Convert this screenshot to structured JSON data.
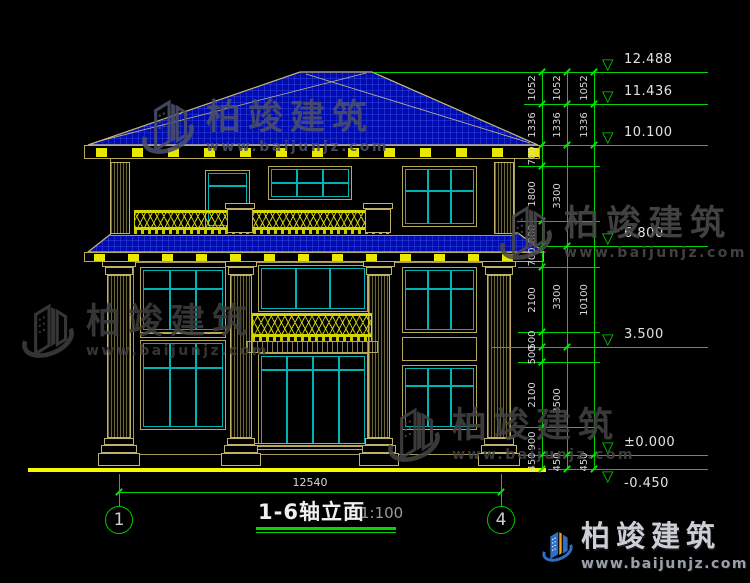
{
  "title": {
    "text": "1-6轴立面",
    "scale": "1:100"
  },
  "axis_bubbles": [
    {
      "label": "1",
      "x": 119
    },
    {
      "label": "4",
      "x": 501
    }
  ],
  "bottom_dimension": {
    "label": "12540",
    "y": 492,
    "x1": 119,
    "x2": 501,
    "text_y": 477
  },
  "elevation_levels": [
    {
      "label": "12.488",
      "y": 72,
      "ext_from": 374
    },
    {
      "label": "11.436",
      "y": 104,
      "ext_from": 524
    },
    {
      "label": "10.100",
      "y": 145,
      "ext_from": 540
    },
    {
      "label": "6.800",
      "y": 246,
      "ext_from": 546
    },
    {
      "label": "3.500",
      "y": 347,
      "ext_from": 492
    },
    {
      "label": "±0.000",
      "y": 455,
      "ext_from": 518
    },
    {
      "label": "-0.450",
      "y": 469,
      "ext_from": 548,
      "below": true
    }
  ],
  "dimension_chains": [
    {
      "x": 542,
      "boundaries": [
        72,
        104,
        145,
        166,
        221,
        246,
        267,
        332,
        347,
        362,
        427,
        455,
        469
      ],
      "labels": [
        "1052",
        "1336",
        "700",
        "1800",
        "800",
        "700",
        "2100",
        "500",
        "500",
        "2100",
        "900",
        "450"
      ]
    },
    {
      "x": 567,
      "boundaries": [
        72,
        104,
        145,
        246,
        347,
        455,
        469
      ],
      "labels": [
        "1052",
        "1336",
        "3300",
        "3300",
        "3500",
        "450"
      ]
    },
    {
      "x": 594,
      "boundaries": [
        72,
        104,
        145,
        455,
        469
      ],
      "labels": [
        "1052",
        "1336",
        "10100",
        "450"
      ]
    }
  ],
  "watermarks": [
    {
      "x": 140,
      "y": 94,
      "color": "#4a5068",
      "brand": "柏竣建筑",
      "url": "www.baijunjz.com"
    },
    {
      "x": 20,
      "y": 298,
      "color": "#3d3d3d",
      "brand": "柏竣建筑",
      "url": "www.baijunjz.com"
    },
    {
      "x": 498,
      "y": 200,
      "color": "#4a4a4a",
      "brand": "柏竣建筑",
      "url": "www.baijunjz.com"
    },
    {
      "x": 386,
      "y": 402,
      "color": "#424242",
      "brand": "柏竣建筑",
      "url": "www.baijunjz.com"
    }
  ],
  "logo": {
    "brand": "柏竣建筑",
    "url": "www.baijunjz.com"
  },
  "facade": {
    "ground_line": {
      "x": 28,
      "y": 468,
      "w": 518,
      "h": 4
    },
    "walls": [
      {
        "name": "third-floor-wall",
        "x": 110,
        "y": 158,
        "w": 405,
        "h": 78
      },
      {
        "name": "main-wall",
        "x": 133,
        "y": 262,
        "w": 357,
        "h": 193
      }
    ],
    "fascias": [
      {
        "name": "main-eave-fascia",
        "x": 84,
        "y": 145,
        "w": 456,
        "h": 14
      },
      {
        "name": "awning-eave-fascia",
        "x": 84,
        "y": 252,
        "w": 460,
        "h": 10
      }
    ],
    "bracket_rows": [
      {
        "y": 148,
        "h": 9,
        "x1": 96,
        "x2": 528,
        "step": 36,
        "w": 11
      },
      {
        "y": 254,
        "h": 7,
        "x1": 94,
        "x2": 534,
        "step": 34,
        "w": 11
      }
    ],
    "windows": [
      {
        "name": "f3-balcony-door",
        "x": 205,
        "y": 170,
        "w": 45,
        "h": 59,
        "cols": 1,
        "rows": 2,
        "tr": 22
      },
      {
        "name": "f3-window-left",
        "x": 268,
        "y": 166,
        "w": 84,
        "h": 34,
        "cols": 3,
        "rows": 2,
        "tr": 45
      },
      {
        "name": "f3-window-right",
        "x": 402,
        "y": 166,
        "w": 75,
        "h": 61,
        "cols": 3,
        "rows": 2,
        "tr": 38
      },
      {
        "name": "f2-window-left",
        "x": 140,
        "y": 267,
        "w": 86,
        "h": 66,
        "cols": 3,
        "rows": 2,
        "tr": 30
      },
      {
        "name": "f2-window-center",
        "x": 258,
        "y": 265,
        "w": 110,
        "h": 47,
        "cols": 3,
        "rows": 1,
        "tr": 0
      },
      {
        "name": "f2-window-right",
        "x": 402,
        "y": 267,
        "w": 75,
        "h": 66,
        "cols": 3,
        "rows": 2,
        "tr": 30
      },
      {
        "name": "f1-window-left",
        "x": 140,
        "y": 340,
        "w": 86,
        "h": 90,
        "cols": 3,
        "rows": 2,
        "tr": 28
      },
      {
        "name": "f1-entrance-door",
        "x": 258,
        "y": 353,
        "w": 110,
        "h": 97,
        "cols": 4,
        "rows": 2,
        "tr": 14
      },
      {
        "name": "f1-window-right",
        "x": 402,
        "y": 365,
        "w": 75,
        "h": 65,
        "cols": 3,
        "rows": 2,
        "tr": 28
      }
    ],
    "panels": [
      {
        "name": "spandrel-right",
        "x": 402,
        "y": 337,
        "w": 75,
        "h": 24
      },
      {
        "name": "spandrel-left",
        "x": 140,
        "y": 333,
        "w": 86,
        "h": 5
      },
      {
        "name": "entry-step-1",
        "x": 248,
        "y": 443,
        "w": 130,
        "h": 3
      },
      {
        "name": "entry-step-2",
        "x": 244,
        "y": 446,
        "w": 138,
        "h": 4
      }
    ],
    "columns": [
      {
        "x": 107,
        "y": 275,
        "w": 24,
        "h": 163
      },
      {
        "x": 230,
        "y": 275,
        "w": 22,
        "h": 163
      },
      {
        "x": 368,
        "y": 275,
        "w": 22,
        "h": 163
      },
      {
        "x": 487,
        "y": 275,
        "w": 24,
        "h": 163
      }
    ],
    "pilasters": [
      {
        "x": 110,
        "y": 162,
        "w": 20,
        "h": 72
      },
      {
        "x": 494,
        "y": 162,
        "w": 20,
        "h": 72
      }
    ],
    "balustrades": [
      {
        "name": "f3-balcony-railing",
        "x": 134,
        "y": 210,
        "w": 257,
        "h": 23,
        "pedestals": [
          {
            "x": 227,
            "w": 26
          },
          {
            "x": 365,
            "w": 26
          }
        ]
      },
      {
        "name": "f2-balcony-railing",
        "x": 252,
        "y": 313,
        "w": 120,
        "h": 27,
        "pedestals": []
      }
    ],
    "slab": {
      "x": 246,
      "y": 341,
      "w": 132,
      "h": 12
    }
  },
  "colors": {
    "background": "#000000",
    "dimension_green": "#00d400",
    "roof_blue": "#000cb0",
    "roof_grid_blue": "#4353f0",
    "frame_tan": "#c0b068",
    "glass_cyan": "#00b4b4",
    "accent_yellow": "#f0f000",
    "dim_text": "#d8d8d8",
    "logo_blue": "#2e6fc4",
    "logo_orange": "#f4a320"
  }
}
